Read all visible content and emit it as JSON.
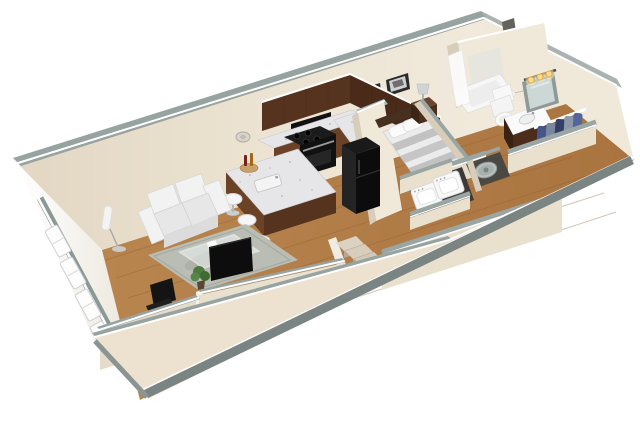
{
  "scene": {
    "title": "Studio apartment 3D cutaway floor plan rendering",
    "type": "3d-floorplan-render",
    "view": "isometric cutaway viewed from above the front-left corner",
    "rooms": [
      {
        "name": "Living Room",
        "items": [
          "white loveseat sofa",
          "glass coffee table",
          "gray-green area rug",
          "wall-mounted flat-screen TV",
          "floor lamp",
          "potted plant",
          "computer desk",
          "monitor",
          "black office chair",
          "windows on end wall"
        ]
      },
      {
        "name": "Kitchen",
        "items": [
          "L-shaped granite counter",
          "dark wood upper cabinets",
          "black range with oven",
          "black microwave",
          "black refrigerator",
          "breakfast bar island with sink",
          "three white bar stools",
          "cutting board with wine bottles"
        ]
      },
      {
        "name": "Bedroom",
        "items": [
          "bed with gray striped duvet",
          "two white pillows",
          "dark wood headboard and footboard",
          "nightstand",
          "table lamp",
          "two framed pictures"
        ]
      },
      {
        "name": "Bathroom",
        "items": [
          "bathtub with white shower curtain",
          "tall shower surround",
          "toilet",
          "dark wood vanity with sink",
          "mirror",
          "lit vanity light bar"
        ]
      },
      {
        "name": "Walk-in Closet",
        "items": [
          "white wire shelves and rods",
          "blue and gray clothes on hangers"
        ]
      },
      {
        "name": "Entry Hallway",
        "items": [
          "entry staircase",
          "side-by-side washer and dryer",
          "round water heater in closet"
        ]
      }
    ],
    "palette": {
      "background": "#ffffff",
      "wall_cream": "#ece3d2",
      "wall_lit": "#f0e8d9",
      "wall_shadow": "#d8cdba",
      "wall_top_gray": "#97a3a1",
      "baseboard_gray": "#7a8583",
      "floor_wood": "#b5824f",
      "cabinet_wood": "#56331f",
      "appliance_black": "#111111",
      "granite": "#e6e6e8",
      "sofa_white": "#f2f2f2",
      "rug_gray_green": "#b9bdb4",
      "bed_stripe_gray": "#c2c2c2",
      "clothes_blue": "#53689a",
      "laundry_white": "#f8f8f8",
      "water_heater_gray": "#b9c0bf",
      "vanity_light_glow": "#ffd98a",
      "plant_green": "#4d7a3c"
    }
  }
}
